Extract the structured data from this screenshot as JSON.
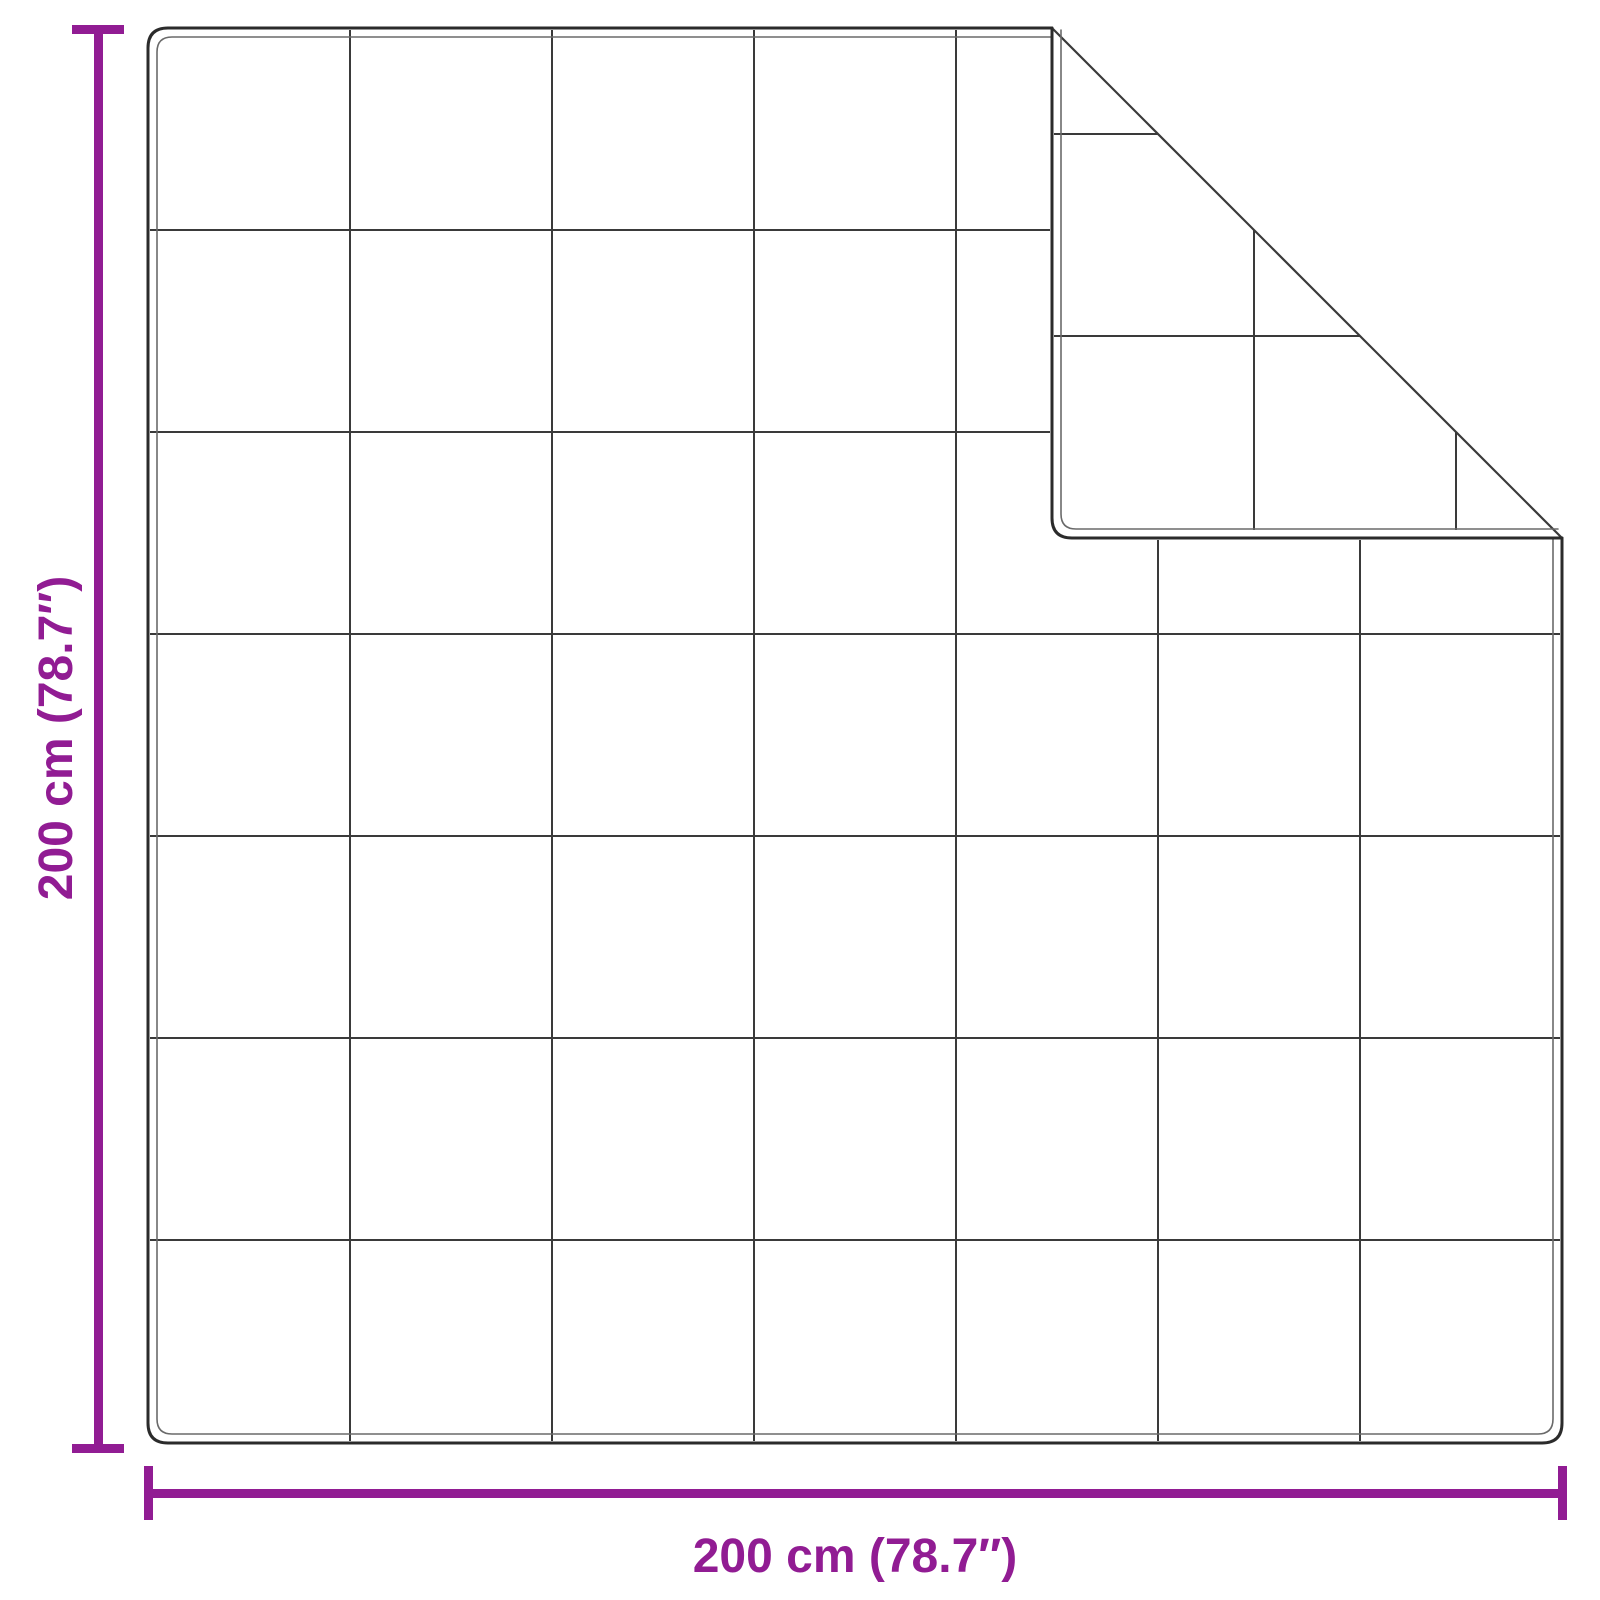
{
  "diagram": {
    "kind": "product dimension diagram",
    "product": "quilted blanket with folded top-right corner",
    "dimensions": {
      "height_label": "200 cm (78.7″)",
      "width_label": "200 cm (78.7″)",
      "height_cm": 200,
      "width_cm": 200,
      "height_inches": 78.7,
      "width_inches": 78.7
    },
    "grid": {
      "rows": 7,
      "cols": 7
    },
    "fold": {
      "corner": "top-right",
      "shape": "45-degree triangle flap showing back-side quilting"
    }
  },
  "colors": {
    "dimension_accent": "#911c93",
    "blanket_outline": "#2b2b2b",
    "blanket_seam": "#6a6a6a",
    "quilt_grid_line": "#3a3a3a",
    "background": "#ffffff"
  }
}
